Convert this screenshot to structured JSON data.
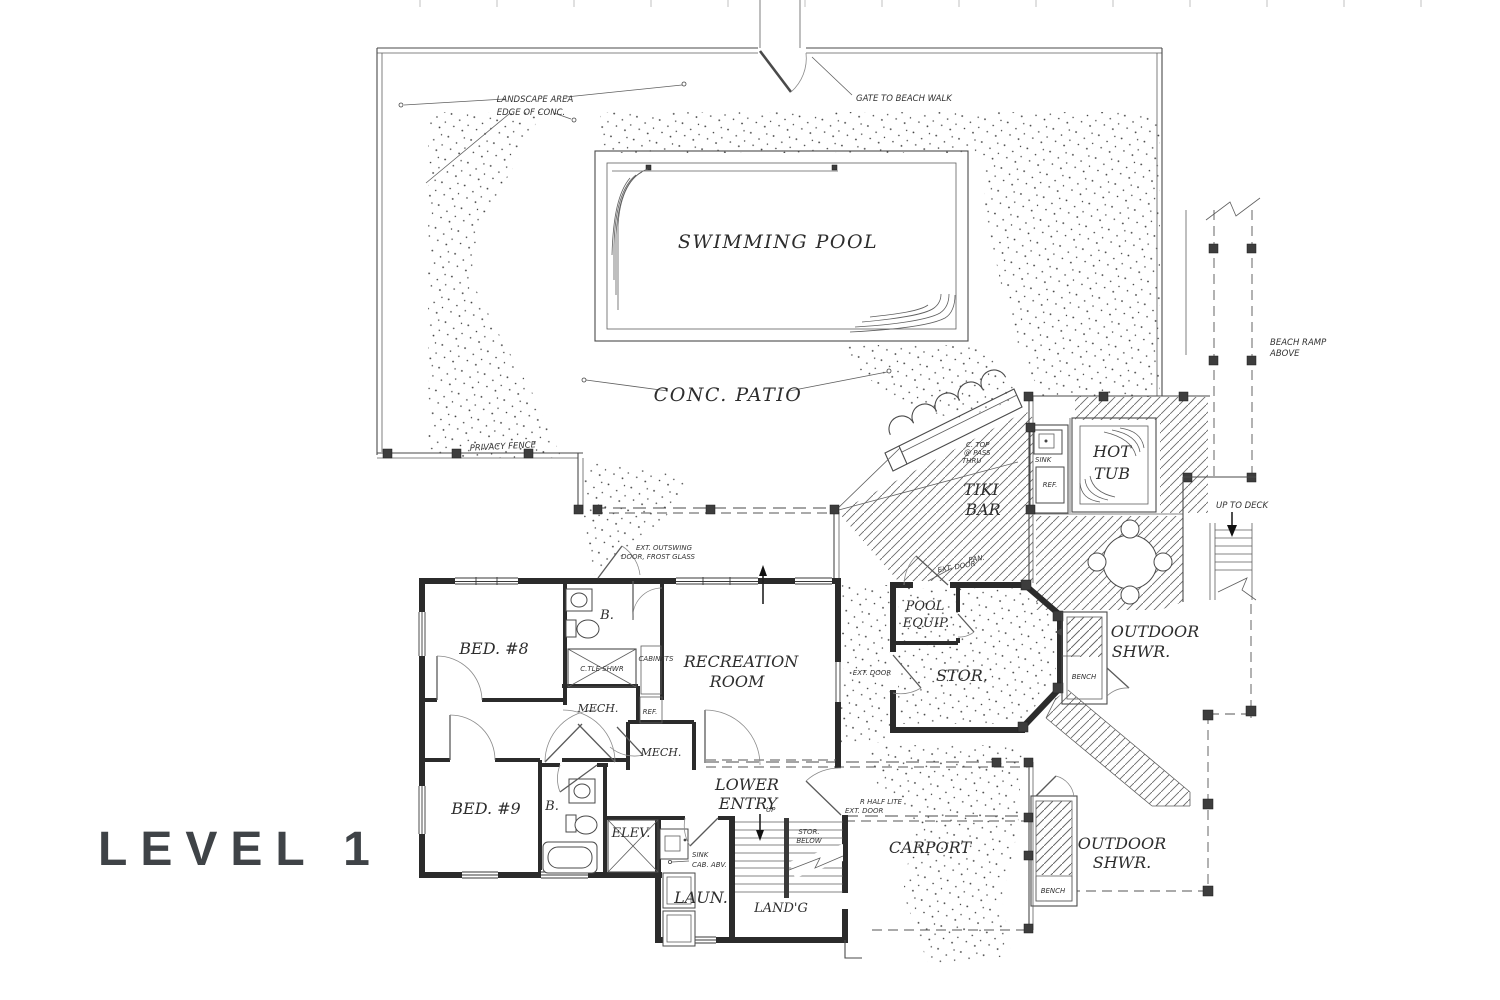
{
  "title": "LEVEL 1",
  "labels": {
    "landscape_area": "LANDSCAPE AREA",
    "edge_of_conc": "EDGE OF CONC.",
    "gate_to_beach_walk": "GATE TO BEACH WALK",
    "swimming_pool": "SWIMMING POOL",
    "conc_patio": "CONC. PATIO",
    "privacy_fence": "PRIVACY FENCE",
    "beach_ramp_1": "BEACH RAMP",
    "beach_ramp_2": "ABOVE",
    "up_to_deck": "UP TO DECK",
    "tiki_1": "TIKI",
    "tiki_2": "BAR",
    "ctop_1": "C. TOP",
    "ctop_2": "@ PASS",
    "ctop_3": "THRU",
    "sink_bar": "SINK",
    "ref_bar": "REF.",
    "hot_1": "HOT",
    "hot_2": "TUB",
    "ext_outswing_1": "EXT. OUTSWING",
    "ext_outswing_2": "DOOR, FROST GLASS",
    "pan": "PAN.",
    "ext_door_pan": "EXT. DOOR",
    "pool_equip_1": "POOL",
    "pool_equip_2": "EQUIP.",
    "ext_door_stor": "EXT. DOOR",
    "stor": "STOR.",
    "bench_upper": "BENCH",
    "outdoor_shwr_u1": "OUTDOOR",
    "outdoor_shwr_u2": "SHWR.",
    "bed8": "BED. #8",
    "bath8": "B.",
    "ctile_shwr": "C.TLE SHWR",
    "cabinets": "CABINETS",
    "mech1": "MECH.",
    "ref_house": "REF.",
    "recreation_1": "RECREATION",
    "recreation_2": "ROOM",
    "mech2": "MECH.",
    "lower_1": "LOWER",
    "lower_2": "ENTRY",
    "up": "UP",
    "stor_below_1": "STOR.",
    "stor_below_2": "BELOW",
    "bed9": "BED. #9",
    "bath9": "B.",
    "elev": "ELEV.",
    "sink_cab_1": "SINK",
    "sink_cab_2": "CAB. ABV.",
    "laun": "LAUN.",
    "landg": "LAND'G",
    "r_half_1": "R HALF LITE",
    "r_half_2": "EXT. DOOR",
    "carport": "CARPORT",
    "outdoor_shwr_l1": "OUTDOOR",
    "outdoor_shwr_l2": "SHWR.",
    "bench_lower": "BENCH"
  }
}
